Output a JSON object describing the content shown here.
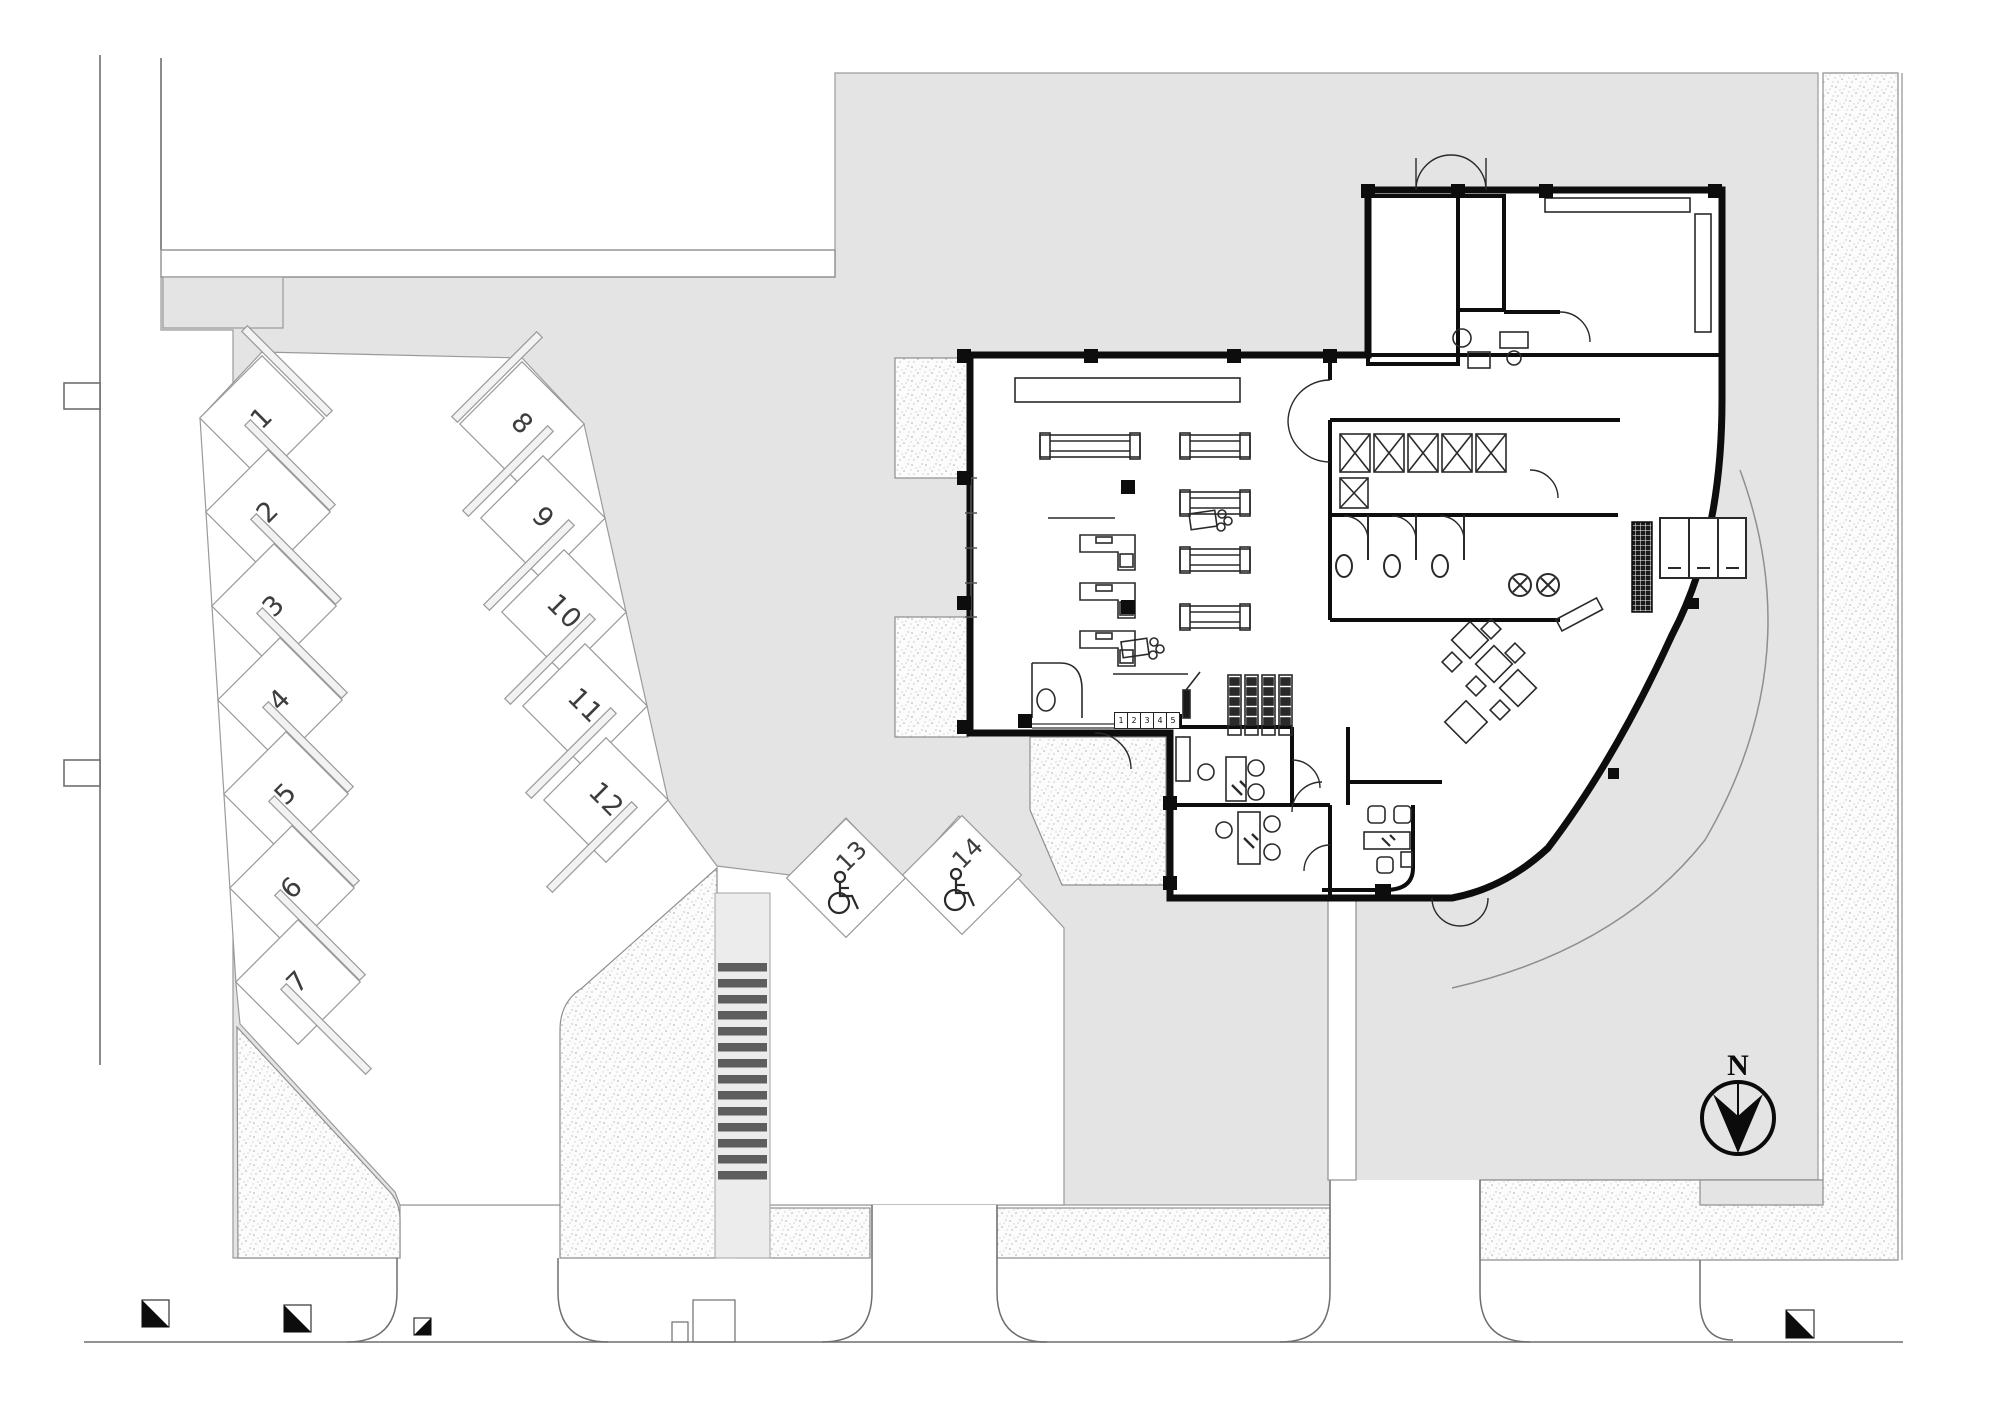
{
  "north_indicator": {
    "label": "N",
    "icon": "north-arrow-icon"
  },
  "parking": {
    "stalls": [
      {
        "label": "1"
      },
      {
        "label": "2"
      },
      {
        "label": "3"
      },
      {
        "label": "4"
      },
      {
        "label": "5"
      },
      {
        "label": "6"
      },
      {
        "label": "7"
      },
      {
        "label": "8"
      },
      {
        "label": "9"
      },
      {
        "label": "10"
      },
      {
        "label": "11"
      },
      {
        "label": "12"
      },
      {
        "label": "13",
        "accessible": true,
        "icon": "wheelchair-icon"
      },
      {
        "label": "14",
        "accessible": true,
        "icon": "wheelchair-icon"
      }
    ]
  },
  "building": {
    "checkout_lane_numbers": [
      "1",
      "2",
      "3",
      "4",
      "5"
    ]
  },
  "colors": {
    "pavement": "#e4e4e4",
    "planting_fill": "#fcfcfc",
    "planting_dot": "#a9a9a9",
    "wall": "#0d0d0d",
    "crosswalk_stripe": "#5e5e5e",
    "line": "#8f8f8f",
    "pad_gray": "#ececec"
  },
  "icons": [
    "north-arrow-icon",
    "wheelchair-icon",
    "shopping-cart-icon",
    "survey-marker-icon"
  ]
}
